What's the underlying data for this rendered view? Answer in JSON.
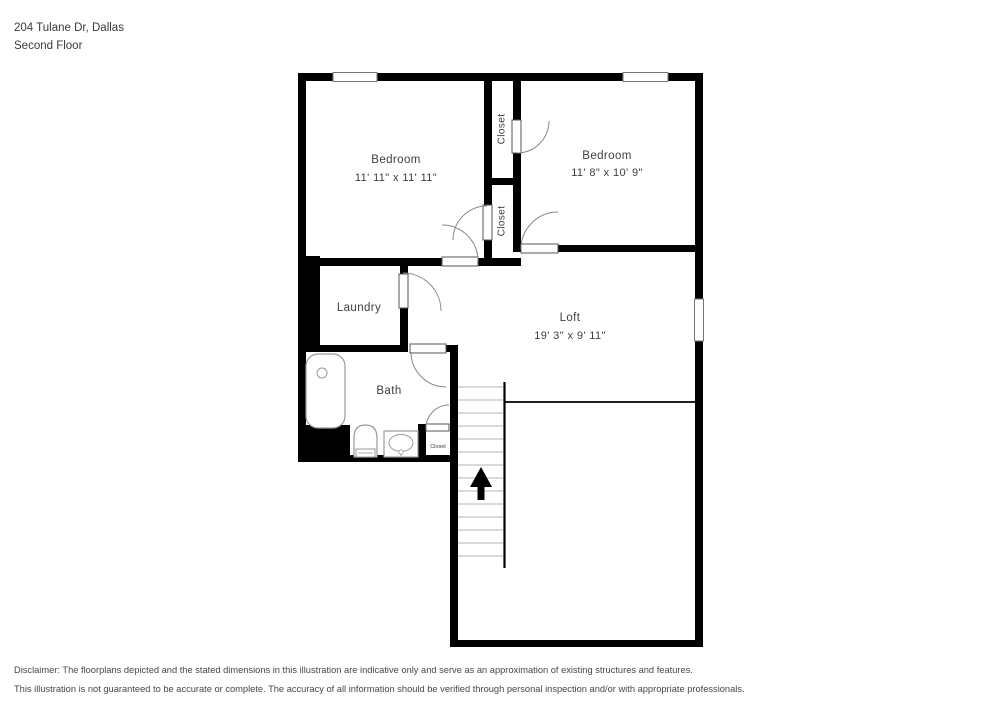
{
  "header": {
    "address": "204 Tulane Dr, Dallas",
    "floor": "Second Floor"
  },
  "floorplan": {
    "rooms": {
      "bedroom_left": {
        "label": "Bedroom",
        "dims": "11' 11\" x 11' 11\""
      },
      "bedroom_right": {
        "label": "Bedroom",
        "dims": "11' 8\" x 10' 9\""
      },
      "loft": {
        "label": "Loft",
        "dims": "19' 3\" x 9' 11\""
      },
      "laundry": {
        "label": "Laundry"
      },
      "bath": {
        "label": "Bath"
      },
      "closet_top": {
        "label": "Closet"
      },
      "closet_bottom": {
        "label": "Closet"
      },
      "closet_bath": {
        "label": "Closet"
      }
    },
    "features": {
      "stairs_direction": "up",
      "fixtures": [
        "bathtub",
        "toilet",
        "sink"
      ]
    },
    "colors": {
      "wall": "#000000",
      "label_text": "#3d3d3d",
      "fixture_outline": "#9a9a9a",
      "stair_tread": "#b3b3b3"
    }
  },
  "footer": {
    "line1": "Disclaimer: The floorplans depicted and the stated dimensions in this illustration are indicative only and serve as an approximation of existing structures and features.",
    "line2": "This illustration is not guaranteed to be accurate or complete. The accuracy of all information should be verified through personal inspection and/or with appropriate professionals."
  }
}
